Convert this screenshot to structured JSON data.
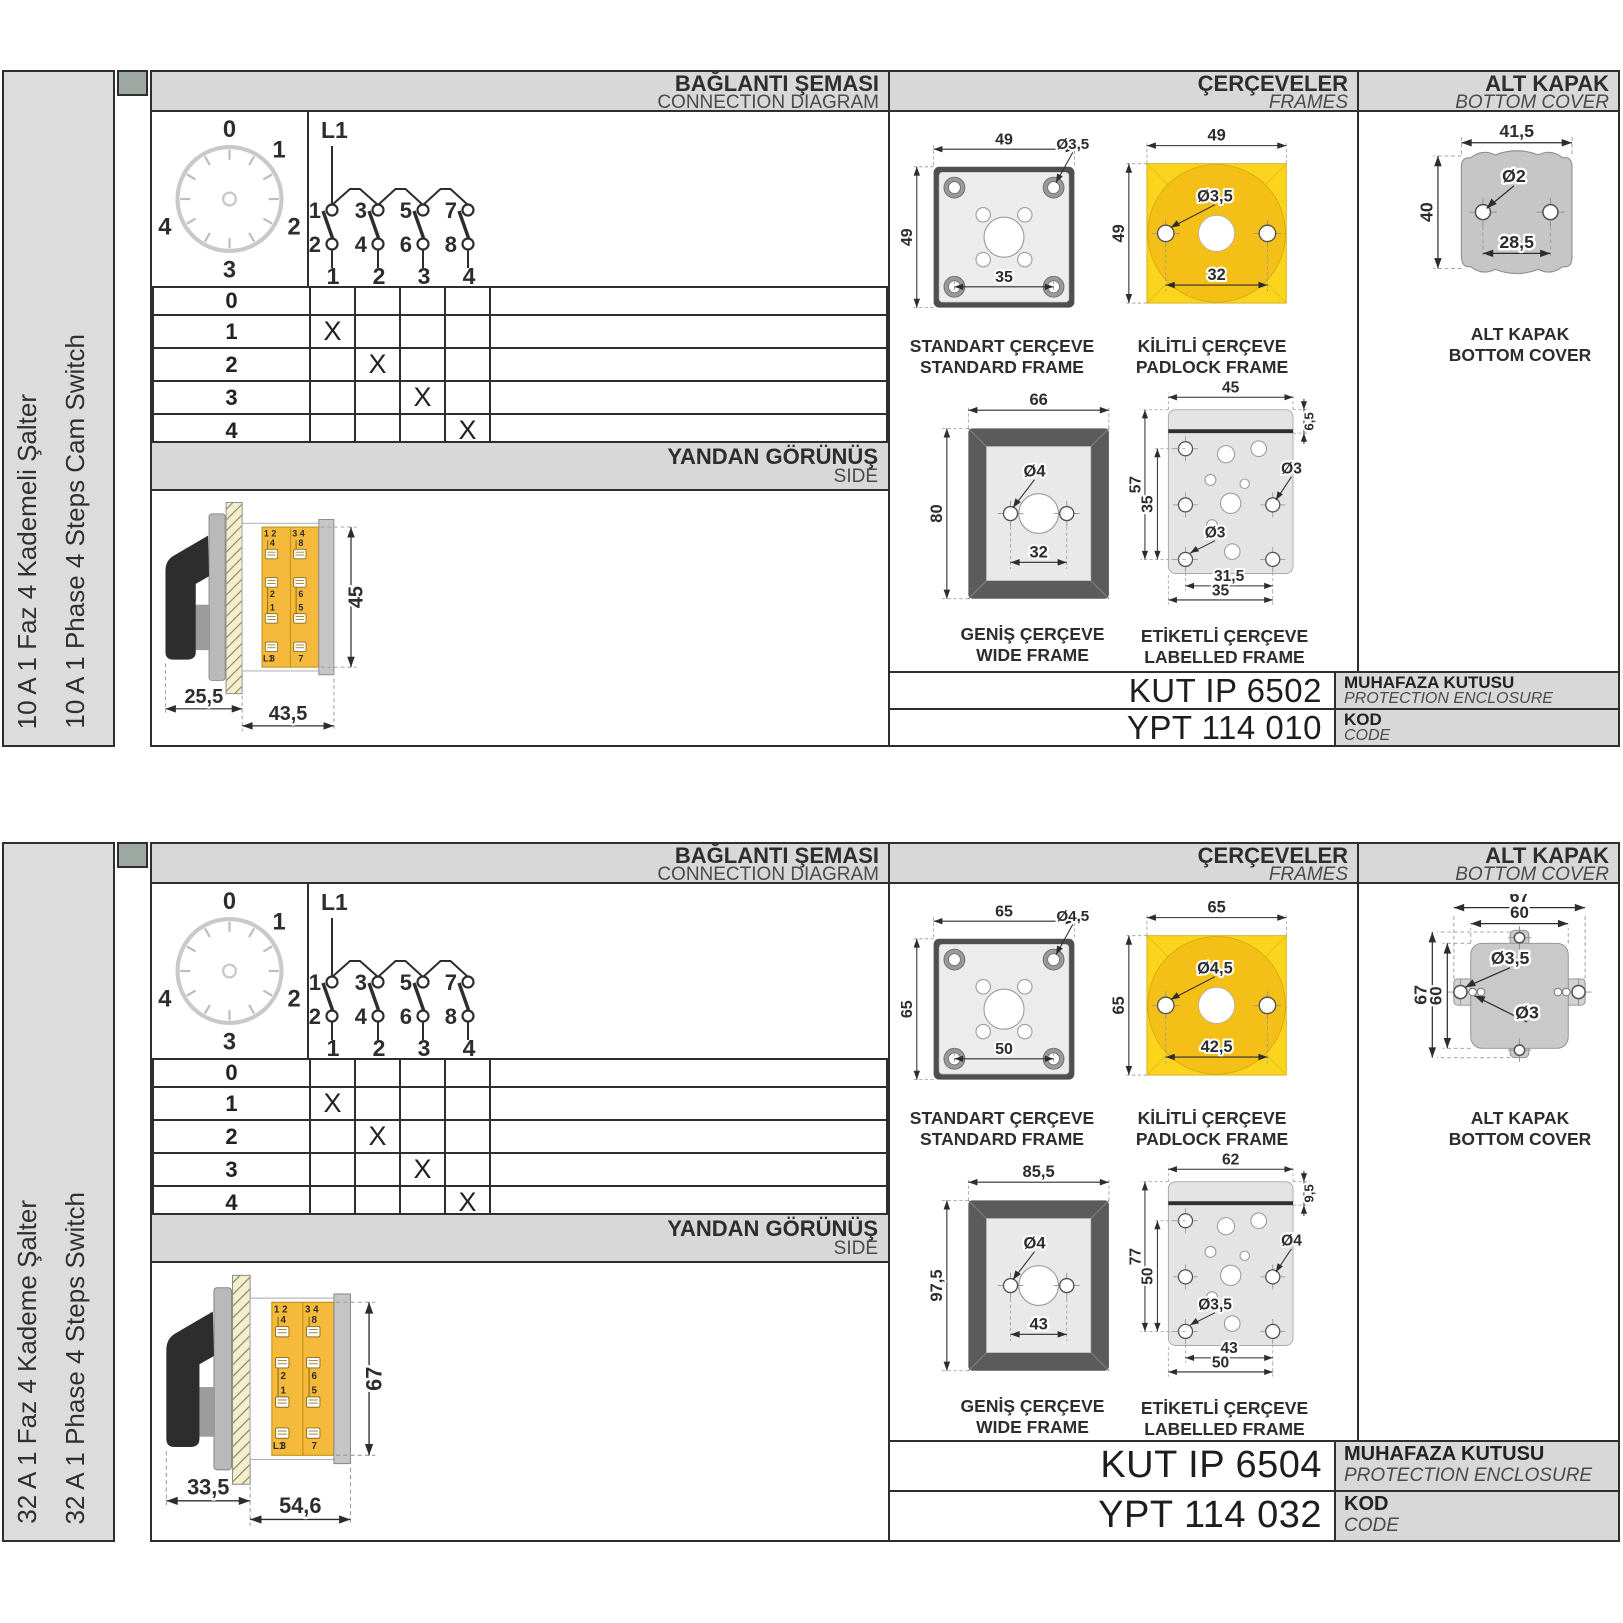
{
  "sections": [
    {
      "side_labels": {
        "tr": "10 A 1 Faz 4 Kademeli Şalter",
        "en": "10 A 1 Phase 4 Steps Cam Switch"
      },
      "headers": {
        "connection": {
          "tr": "BAĞLANTI ŞEMASI",
          "en": "CONNECTION DIAGRAM"
        },
        "frames": {
          "tr": "ÇERÇEVELER",
          "en": "FRAMES"
        },
        "cover": {
          "tr": "ALT KAPAK",
          "en": "BOTTOM COVER"
        },
        "side_view": {
          "tr": "YANDAN GÖRÜNÜŞ",
          "en": "SIDE"
        }
      },
      "dial": {
        "positions": [
          "0",
          "1",
          "2",
          "3",
          "4"
        ]
      },
      "circuit": {
        "feed": "L1",
        "top_terminals": [
          "1",
          "3",
          "5",
          "7"
        ],
        "bottom_terminals": [
          "2",
          "4",
          "6",
          "8"
        ],
        "poles": [
          "1",
          "2",
          "3",
          "4"
        ]
      },
      "step_table": {
        "rows": [
          {
            "label": "0",
            "marks": [
              "",
              "",
              "",
              ""
            ]
          },
          {
            "label": "1",
            "marks": [
              "X",
              "",
              "",
              ""
            ]
          },
          {
            "label": "2",
            "marks": [
              "",
              "X",
              "",
              ""
            ]
          },
          {
            "label": "3",
            "marks": [
              "",
              "",
              "X",
              ""
            ]
          },
          {
            "label": "4",
            "marks": [
              "",
              "",
              "",
              "X"
            ]
          }
        ]
      },
      "side_view": {
        "dims": {
          "front": "25,5",
          "body": "43,5",
          "height": "45"
        },
        "block": {
          "col_headers": [
            "1 2",
            "3 4"
          ],
          "terminals_left": [
            "4",
            "2",
            "1",
            "3"
          ],
          "terminals_right": [
            "8",
            "6",
            "5",
            "7"
          ],
          "feed": "L1"
        }
      },
      "frames": {
        "standard": {
          "caption_tr": "STANDART ÇERÇEVE",
          "caption_en": "STANDARD FRAME",
          "width": "49",
          "height": "49",
          "hole": "Ø3,5",
          "hole_span": "35"
        },
        "padlock": {
          "caption_tr": "KİLİTLİ ÇERÇEVE",
          "caption_en": "PADLOCK FRAME",
          "width": "49",
          "height": "49",
          "hole": "Ø3,5",
          "hole_span": "32"
        },
        "wide": {
          "caption_tr": "GENİŞ ÇERÇEVE",
          "caption_en": "WIDE FRAME",
          "width": "66",
          "height": "80",
          "hole": "Ø4",
          "hole_span": "32"
        },
        "labelled": {
          "caption_tr": "ETİKETLİ ÇERÇEVE",
          "caption_en": "LABELLED FRAME",
          "top": "45",
          "right": "6,5",
          "left_outer": "57",
          "left_inner": "35",
          "hole_right": "Ø3",
          "hole_left": "Ø3",
          "bottom_inner": "31,5",
          "bottom_outer": "35"
        }
      },
      "bottom_cover": {
        "caption_tr": "ALT KAPAK",
        "caption_en": "BOTTOM COVER",
        "width": "41,5",
        "height": "40",
        "hole": "Ø2",
        "hole_span": "28,5"
      },
      "codes": {
        "enclosure": {
          "value": "KUT IP 6502",
          "label_tr": "MUHAFAZA KUTUSU",
          "label_en": "PROTECTION ENCLOSURE"
        },
        "code": {
          "value": "YPT 114 010",
          "label_tr": "KOD",
          "label_en": "CODE"
        }
      }
    },
    {
      "side_labels": {
        "tr": "32 A 1 Faz 4 Kademe Şalter",
        "en": "32 A 1 Phase 4 Steps Switch"
      },
      "headers": {
        "connection": {
          "tr": "BAĞLANTI ŞEMASI",
          "en": "CONNECTION DIAGRAM"
        },
        "frames": {
          "tr": "ÇERÇEVELER",
          "en": "FRAMES"
        },
        "cover": {
          "tr": "ALT KAPAK",
          "en": "BOTTOM COVER"
        },
        "side_view": {
          "tr": "YANDAN GÖRÜNÜŞ",
          "en": "SIDE"
        }
      },
      "dial": {
        "positions": [
          "0",
          "1",
          "2",
          "3",
          "4"
        ]
      },
      "circuit": {
        "feed": "L1",
        "top_terminals": [
          "1",
          "3",
          "5",
          "7"
        ],
        "bottom_terminals": [
          "2",
          "4",
          "6",
          "8"
        ],
        "poles": [
          "1",
          "2",
          "3",
          "4"
        ]
      },
      "step_table": {
        "rows": [
          {
            "label": "0",
            "marks": [
              "",
              "",
              "",
              ""
            ]
          },
          {
            "label": "1",
            "marks": [
              "X",
              "",
              "",
              ""
            ]
          },
          {
            "label": "2",
            "marks": [
              "",
              "X",
              "",
              ""
            ]
          },
          {
            "label": "3",
            "marks": [
              "",
              "",
              "X",
              ""
            ]
          },
          {
            "label": "4",
            "marks": [
              "",
              "",
              "",
              "X"
            ]
          }
        ]
      },
      "side_view": {
        "dims": {
          "front": "33,5",
          "body": "54,6",
          "height": "67"
        },
        "block": {
          "col_headers": [
            "1 2",
            "3 4"
          ],
          "terminals_left": [
            "4",
            "2",
            "1",
            "3"
          ],
          "terminals_right": [
            "8",
            "6",
            "5",
            "7"
          ],
          "feed": "L1"
        }
      },
      "frames": {
        "standard": {
          "caption_tr": "STANDART ÇERÇEVE",
          "caption_en": "STANDARD FRAME",
          "width": "65",
          "height": "65",
          "hole": "Ø4,5",
          "hole_span": "50"
        },
        "padlock": {
          "caption_tr": "KİLİTLİ ÇERÇEVE",
          "caption_en": "PADLOCK FRAME",
          "width": "65",
          "height": "65",
          "hole": "Ø4,5",
          "hole_span": "42,5"
        },
        "wide": {
          "caption_tr": "GENİŞ ÇERÇEVE",
          "caption_en": "WIDE FRAME",
          "width": "85,5",
          "height": "97,5",
          "hole": "Ø4",
          "hole_span": "43"
        },
        "labelled": {
          "caption_tr": "ETİKETLİ ÇERÇEVE",
          "caption_en": "LABELLED FRAME",
          "top": "62",
          "right": "9,5",
          "left_outer": "77",
          "left_inner": "50",
          "hole_right": "Ø4",
          "hole_left": "Ø3,5",
          "bottom_inner": "43",
          "bottom_outer": "50"
        }
      },
      "bottom_cover": {
        "caption_tr": "ALT KAPAK",
        "caption_en": "BOTTOM COVER",
        "width_outer": "67",
        "width_inner": "60",
        "height_outer": "67",
        "height_inner": "60",
        "hole_big": "Ø3,5",
        "hole_small": "Ø3"
      },
      "codes": {
        "enclosure": {
          "value": "KUT IP 6504",
          "label_tr": "MUHAFAZA KUTUSU",
          "label_en": "PROTECTION ENCLOSURE"
        },
        "code": {
          "value": "YPT 114 032",
          "label_tr": "KOD",
          "label_en": "CODE"
        }
      }
    }
  ]
}
